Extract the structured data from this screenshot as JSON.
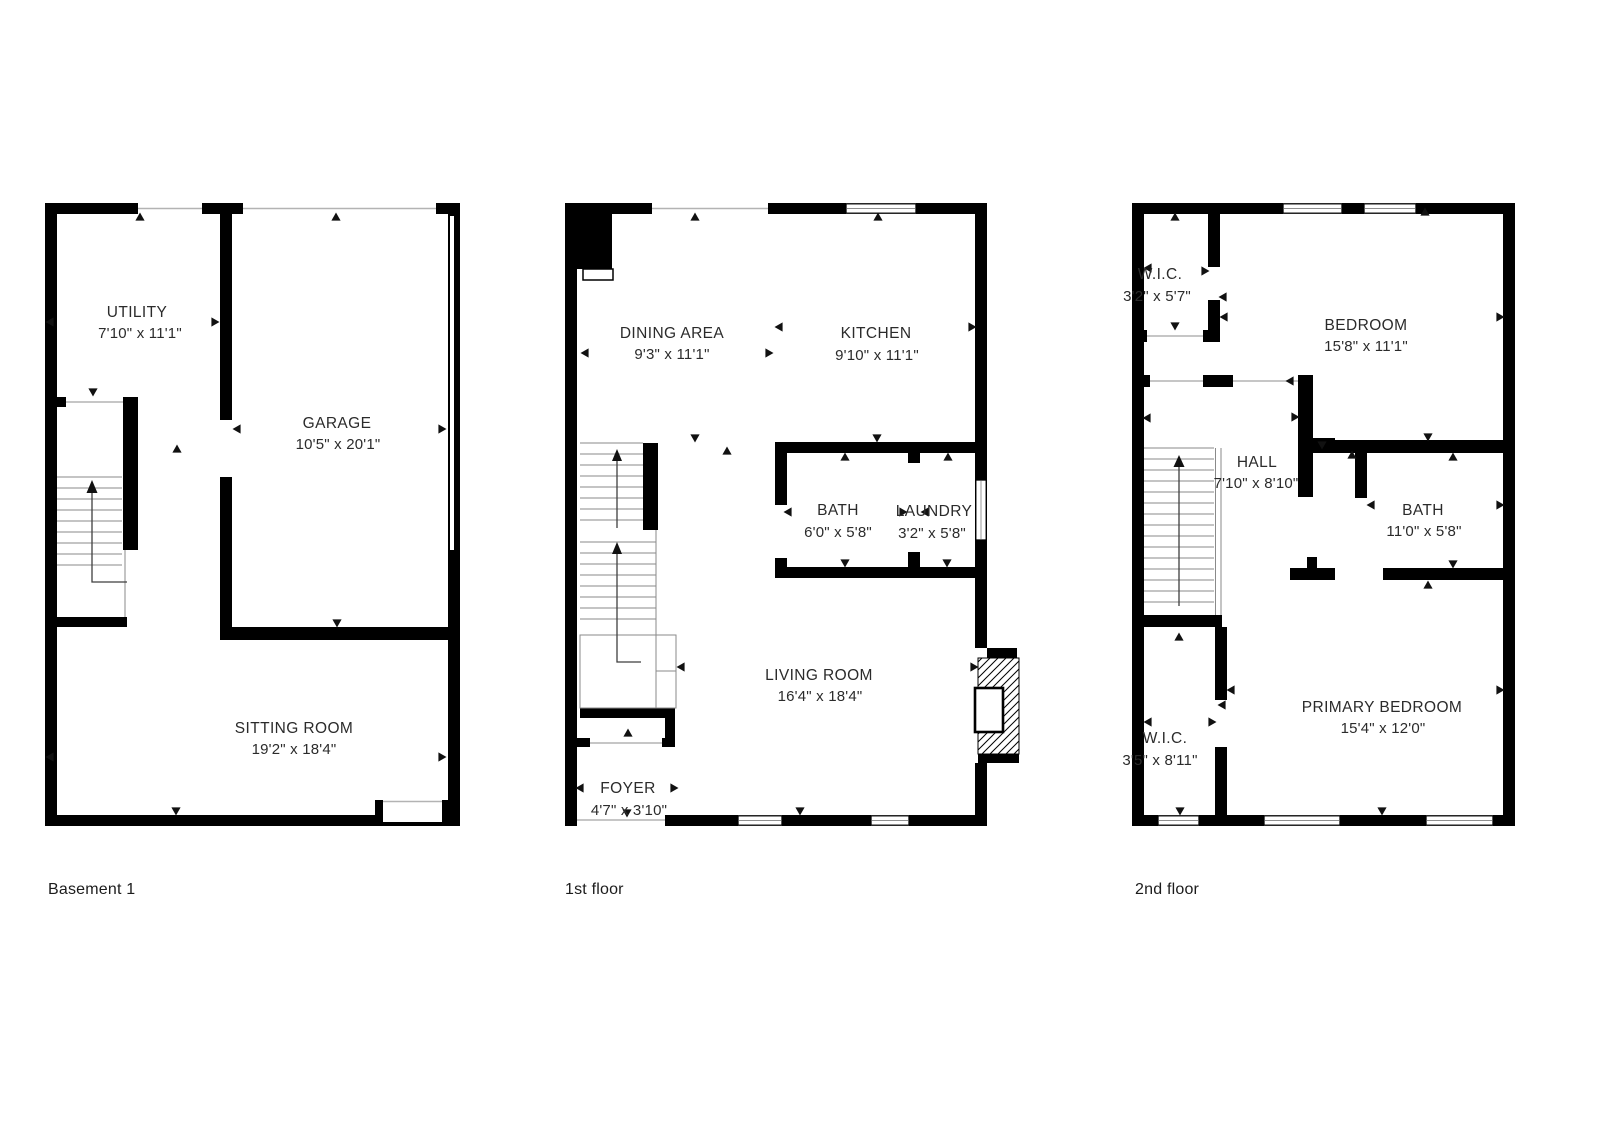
{
  "figure_type": "floor-plan-sheet",
  "colors": {
    "wall": "#000000",
    "opening_line": "#b3b3b3",
    "text": "#2b2b2b",
    "background": "#ffffff"
  },
  "floors": [
    {
      "name": "Basement 1",
      "rooms": [
        {
          "label": "UTILITY",
          "dims": "7'10\" x 11'1\""
        },
        {
          "label": "GARAGE",
          "dims": "10'5\" x 20'1\""
        },
        {
          "label": "SITTING ROOM",
          "dims": "19'2\" x 18'4\""
        }
      ]
    },
    {
      "name": "1st floor",
      "rooms": [
        {
          "label": "DINING AREA",
          "dims": "9'3\" x 11'1\""
        },
        {
          "label": "KITCHEN",
          "dims": "9'10\" x 11'1\""
        },
        {
          "label": "BATH",
          "dims": "6'0\" x 5'8\""
        },
        {
          "label": "LAUNDRY",
          "dims": "3'2\" x 5'8\""
        },
        {
          "label": "LIVING ROOM",
          "dims": "16'4\" x 18'4\""
        },
        {
          "label": "FOYER",
          "dims": "4'7\" x 3'10\""
        }
      ]
    },
    {
      "name": "2nd floor",
      "rooms": [
        {
          "label": "W.I.C.",
          "dims": "3'2\" x 5'7\""
        },
        {
          "label": "BEDROOM",
          "dims": "15'8\" x 11'1\""
        },
        {
          "label": "HALL",
          "dims": "7'10\" x 8'10\""
        },
        {
          "label": "BATH",
          "dims": "11'0\" x 5'8\""
        },
        {
          "label": "W.I.C.",
          "dims": "3'5\" x 8'11\""
        },
        {
          "label": "PRIMARY BEDROOM",
          "dims": "15'4\" x 12'0\""
        }
      ]
    }
  ]
}
